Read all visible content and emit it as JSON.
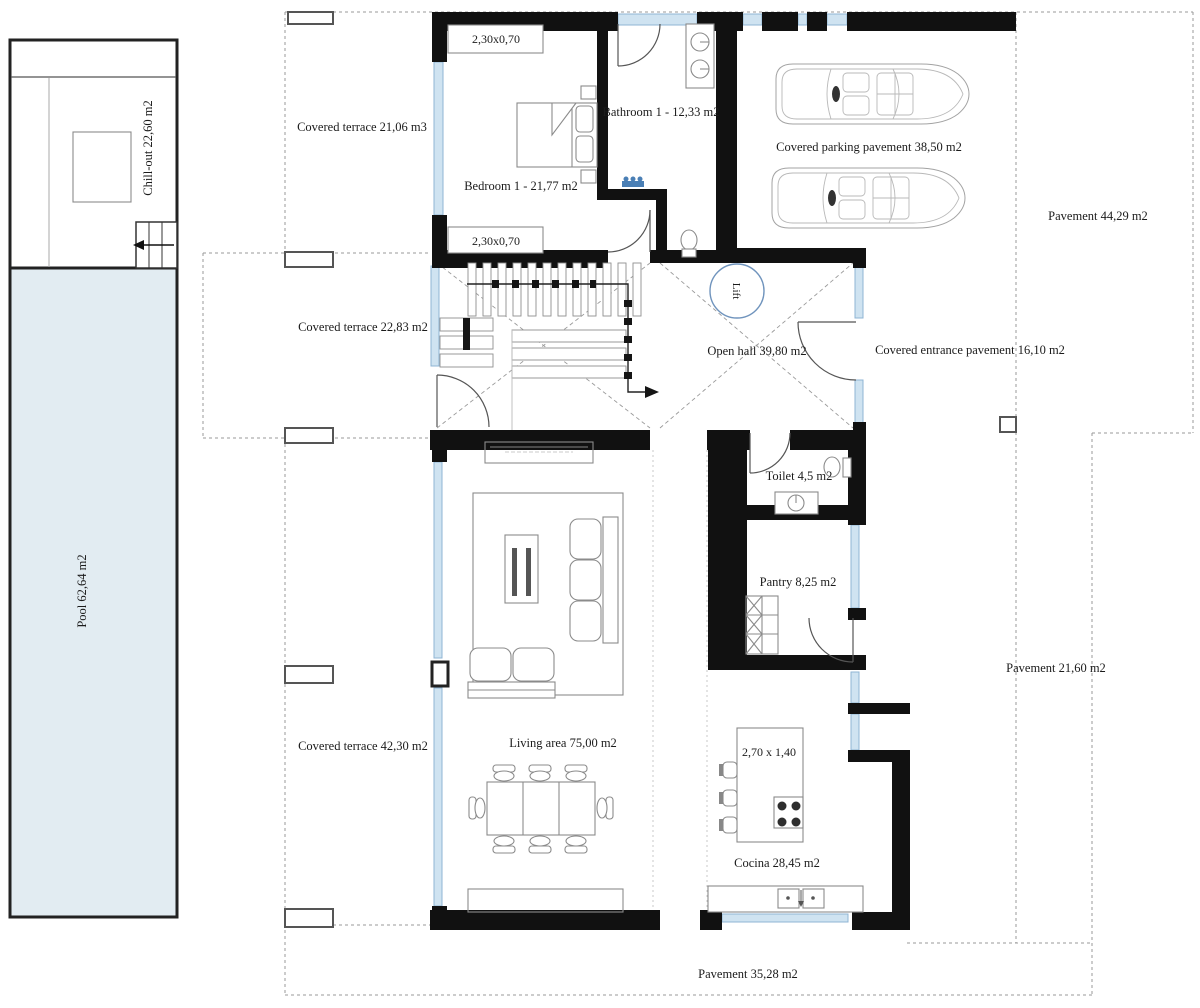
{
  "plan": {
    "rooms": {
      "bedroom1": "Bedroom 1 -  21,77 m2",
      "bathroom1": "Bathroom 1 -  12,33 m2",
      "open_hall": "Open hall 39,80 m2",
      "lift": "Lift",
      "toilet": "Toilet 4,5 m2",
      "pantry": "Pantry 8,25 m2",
      "living_area": "Living area 75,00 m2",
      "cocina": "Cocina 28,45 m2"
    },
    "outdoor": {
      "covered_terrace_top": "Covered terrace 21,06 m3",
      "covered_terrace_mid": "Covered terrace 22,83 m2",
      "covered_terrace_bottom": "Covered terrace 42,30 m2",
      "covered_parking": "Covered parking pavement 38,50 m2",
      "covered_entrance": "Covered entrance pavement 16,10 m2",
      "pavement_right": "Pavement 44,29 m2",
      "pavement_mid_right": "Pavement 21,60 m2",
      "pavement_bottom": "Pavement 35,28 m2",
      "chill_out": "Chill-out 22,60 m2",
      "pool": "Pool 62,64 m2"
    },
    "dims": {
      "closet_top": "2,30x0,70",
      "closet_bottom": "2,30x0,70",
      "island": "2,70 x 1,40"
    },
    "colors": {
      "wall": "#111111",
      "window": "#cfe3f1",
      "window_stroke": "#8fb4d4",
      "pool_fill": "#e2ecf2",
      "dashed": "#9a9a9a",
      "lift_stroke": "#7094bd",
      "furniture": "#8b8b8b",
      "text": "#1b1b1b",
      "accent_blue": "#4a7fb5",
      "car": "#a3a3a3"
    }
  }
}
